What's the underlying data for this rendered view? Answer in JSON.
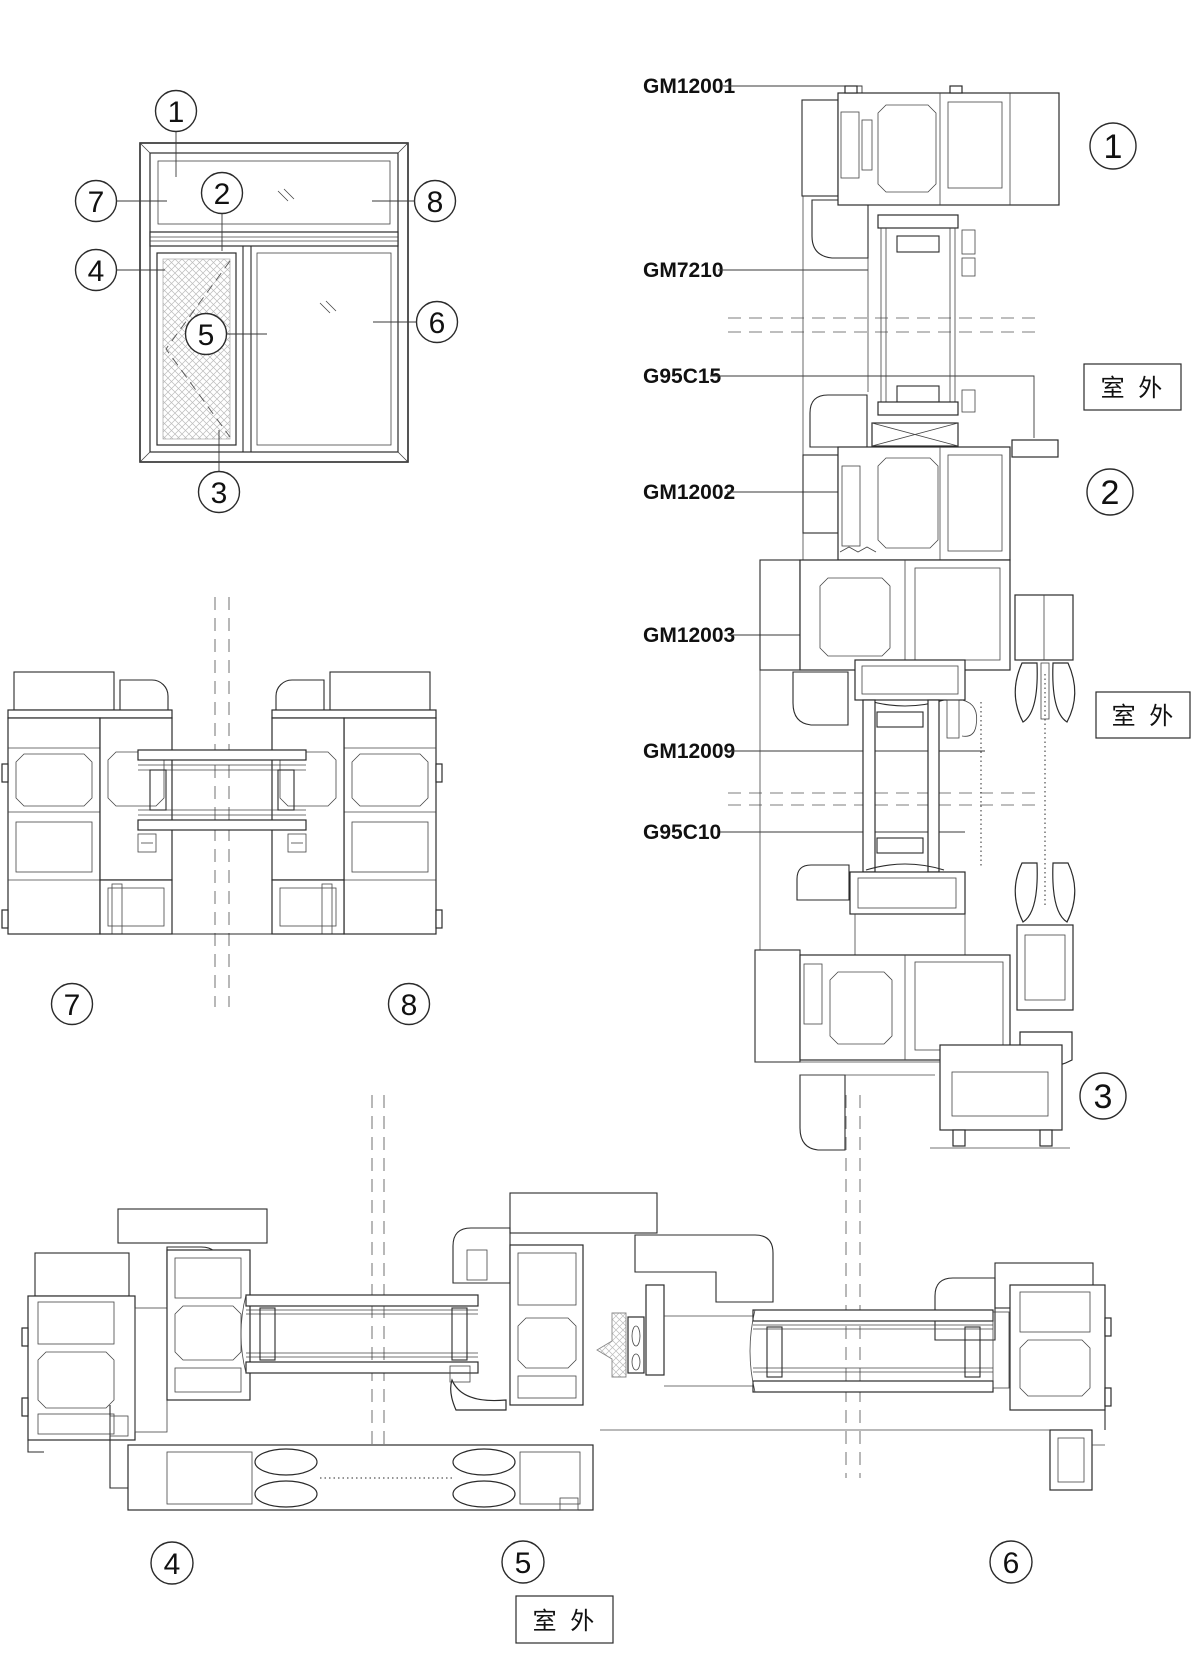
{
  "page": {
    "background": "#ffffff",
    "line_color": "#2b2b2b",
    "drawing_type": "aluminum window section details"
  },
  "outdoor_label": "室 外",
  "callouts": {
    "c1": "1",
    "c2": "2",
    "c3": "3",
    "c4": "4",
    "c5": "5",
    "c6": "6",
    "c7": "7",
    "c8": "8"
  },
  "part_labels": {
    "gm12001": "GM12001",
    "gm7210": "GM7210",
    "g95c15": "G95C15",
    "gm12002": "GM12002",
    "gm12003": "GM12003",
    "gm12009": "GM12009",
    "g95c10": "G95C10"
  }
}
